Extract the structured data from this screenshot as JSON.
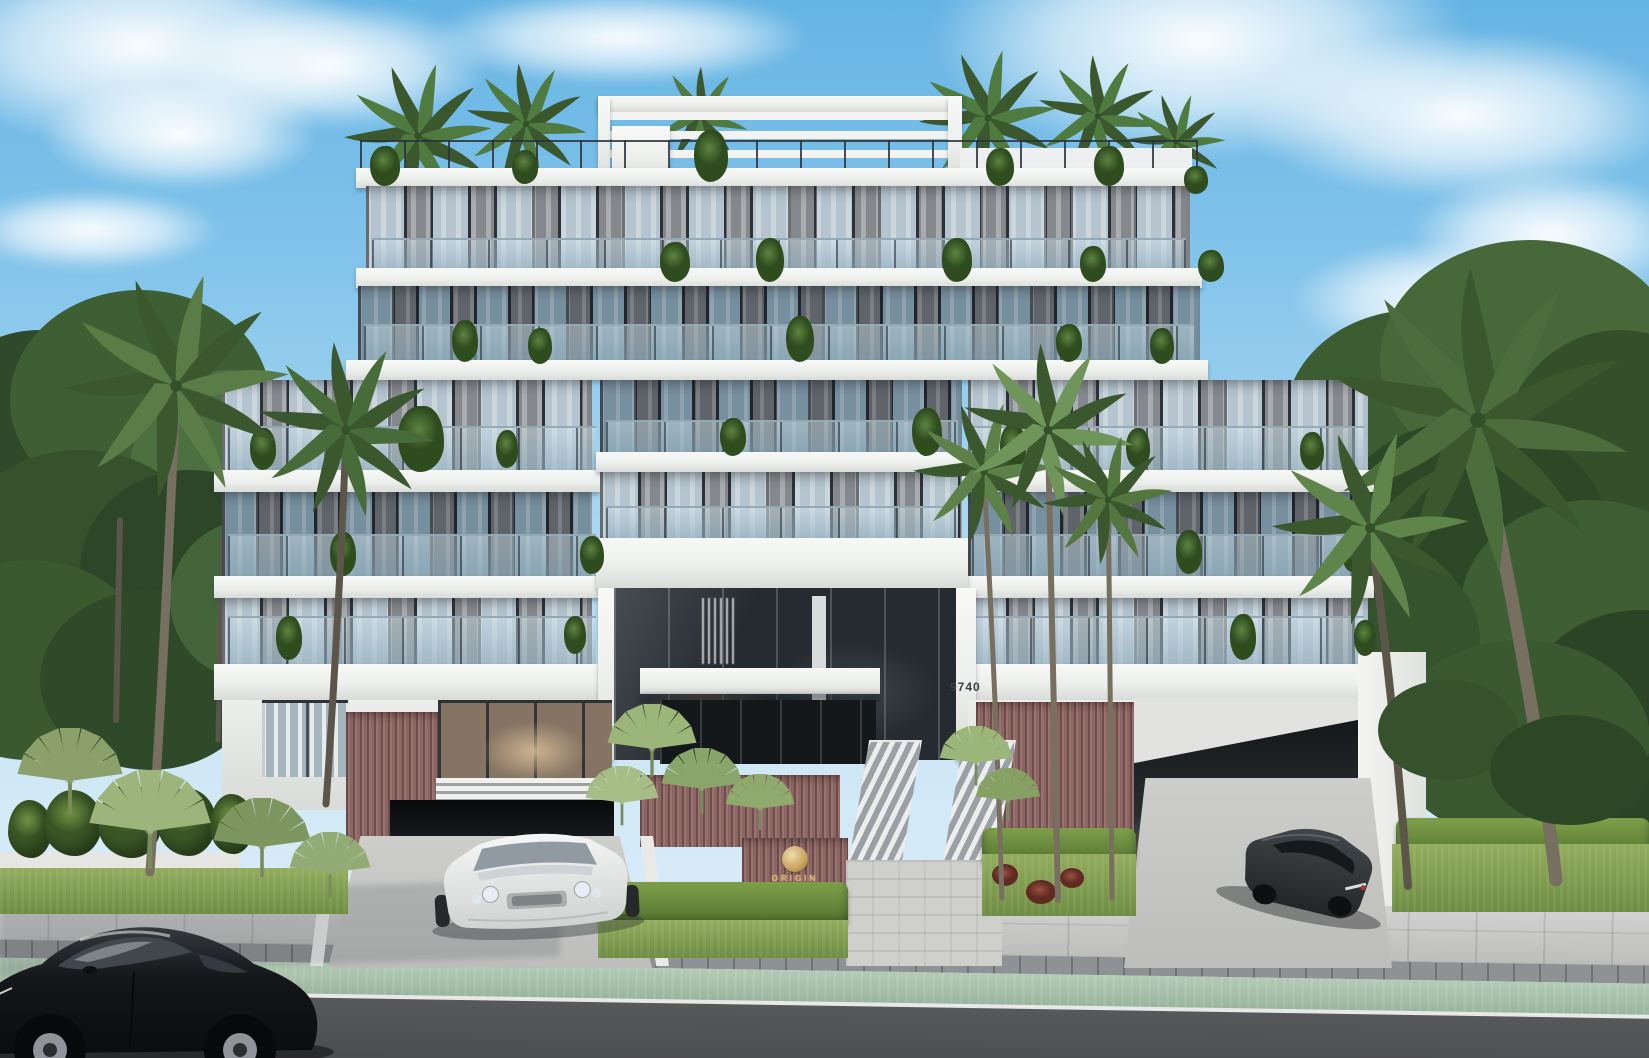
{
  "scene": {
    "type": "exterior architectural rendering",
    "setting": "modern luxury boutique condominium with tropical landscaping, viewed from the street",
    "building": {
      "address_number": "9740",
      "entrance_sign": {
        "brand_text": "ORIGIN",
        "logo": "gold-disc"
      },
      "floors_visible": 7,
      "features": [
        "rooftop pergola terrace",
        "glass balcony railings with potted plants",
        "double-height glass lobby",
        "two parking garage entries",
        "mauve slatted accent panels",
        "entry stairs with glass rails"
      ]
    },
    "vehicles": [
      "white luxury coupe in left driveway",
      "dark gray SUV in right driveway",
      "black sedan on street in foreground"
    ],
    "street": [
      "paver sidewalk",
      "dark paver border strip",
      "green bike lane",
      "white curb line",
      "asphalt road"
    ],
    "palette": {
      "sky_blue": "#7fc2ea",
      "cloud_white": "#ffffff",
      "facade_white": "#f1f2f0",
      "facade_dark_gray": "#5b6066",
      "glass_blue_gray": "#b5c4cf",
      "accent_mauve": "#8d6663",
      "brand_gold": "#d8b578",
      "foliage_green": "#4f7038",
      "grass_green": "#7d9b52",
      "bike_lane_green": "#a9c4ac",
      "asphalt_gray": "#4e4f51"
    }
  }
}
